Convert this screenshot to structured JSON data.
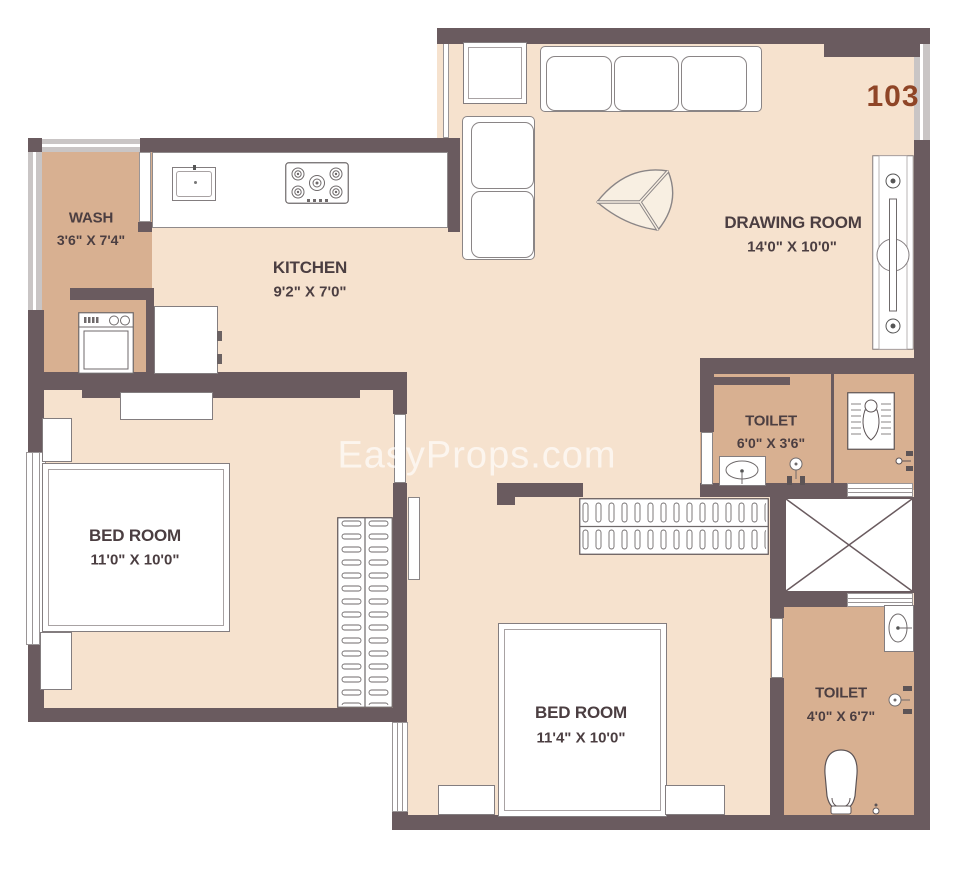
{
  "unit_number": "103",
  "watermark": "EasyProps.com",
  "colors": {
    "wall": "#6a5b5f",
    "floor": "#f6e2ce",
    "service": "#d8b091",
    "ink": "#4b3e41",
    "unit_accent": "#8f4527",
    "watermark_color": "rgba(255,255,255,0.65)"
  },
  "rooms": {
    "wash": {
      "name": "WASH",
      "dims": "3'6\" X 7'4\""
    },
    "kitchen": {
      "name": "KITCHEN",
      "dims": "9'2\" X 7'0\""
    },
    "drawing": {
      "name": "DRAWING ROOM",
      "dims": "14'0\" X 10'0\""
    },
    "toilet1": {
      "name": "TOILET",
      "dims": "6'0\" X 3'6\""
    },
    "bedroom1": {
      "name": "BED ROOM",
      "dims": "11'0\" X 10'0\""
    },
    "bedroom2": {
      "name": "BED ROOM",
      "dims": "11'4\" X 10'0\""
    },
    "toilet2": {
      "name": "TOILET",
      "dims": "4'0\" X 6'7\""
    }
  },
  "fixtures": [
    "sofa-3-seater",
    "sofa-2-seater",
    "corner-table",
    "coffee-table",
    "main-door",
    "kitchen-counter",
    "kitchen-sink",
    "gas-stove",
    "refrigerator",
    "washing-machine",
    "wash-basin",
    "shower",
    "squat-toilet",
    "water-closet",
    "bed",
    "side-table",
    "dresser",
    "wardrobe",
    "duct-shaft",
    "window",
    "door-leaf"
  ]
}
